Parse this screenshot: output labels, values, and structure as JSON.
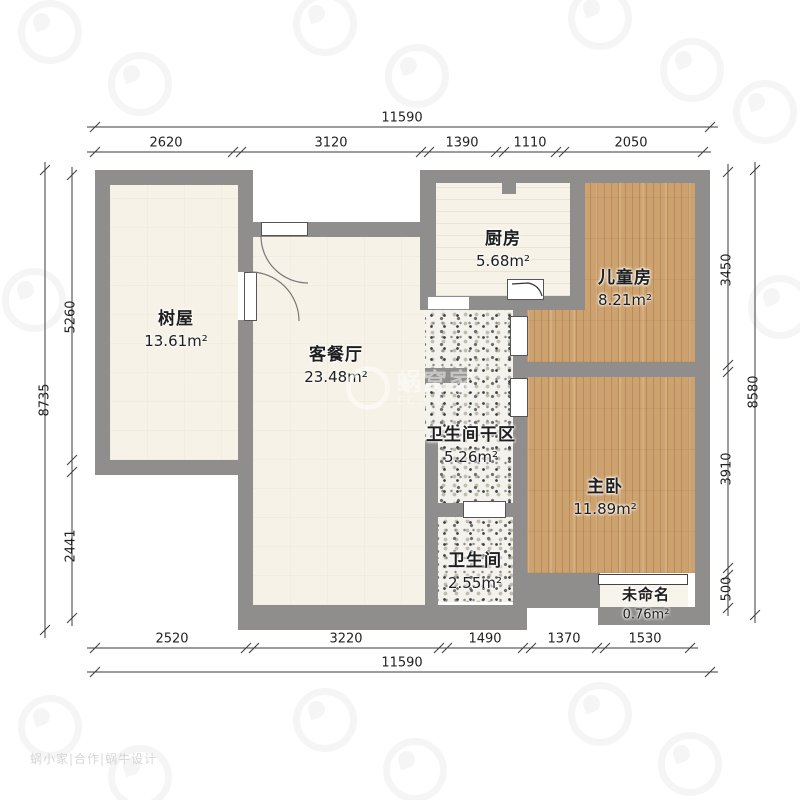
{
  "plan": {
    "rooms": [
      {
        "name": "树屋",
        "area": "13.61m²"
      },
      {
        "name": "客餐厅",
        "area": "23.48m²"
      },
      {
        "name": "厨房",
        "area": "5.68m²"
      },
      {
        "name": "儿童房",
        "area": "8.21m²"
      },
      {
        "name": "卫生间干区",
        "area": "5.26m²"
      },
      {
        "name": "主卧",
        "area": "11.89m²"
      },
      {
        "name": "卫生间",
        "area": "2.55m²"
      },
      {
        "name": "未命名",
        "area": "0.76m²"
      }
    ]
  },
  "dimensions": {
    "top": {
      "total": "11590",
      "segments": [
        "2620",
        "3120",
        "1390",
        "1110",
        "2050"
      ]
    },
    "bottom": {
      "total": "11590",
      "segments": [
        "2520",
        "3220",
        "1490",
        "1370",
        "1530"
      ]
    },
    "left": {
      "total": "8735",
      "segments": [
        "5260",
        "2441"
      ]
    },
    "right": {
      "total": "8580",
      "segments": [
        "3450",
        "3910",
        "500"
      ]
    }
  },
  "watermark": {
    "brand": "蜗窝家",
    "sub": "EC.CO",
    "footer": "蜗小家|合作|蜗牛设计"
  },
  "colors": {
    "wall": "#8f8e8c",
    "wood": "#cda26e",
    "cream": "#f6f2e7",
    "terrazzo": "#f4f2ed",
    "dim": "#3a3a3a"
  }
}
